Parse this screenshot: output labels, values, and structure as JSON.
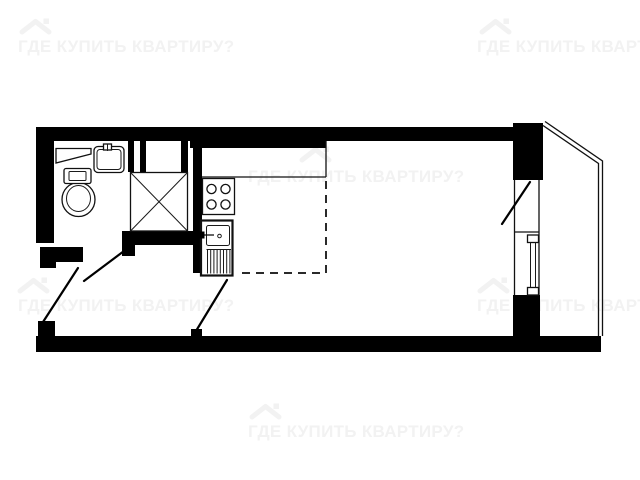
{
  "watermark": {
    "text": "ГДЕ КУПИТЬ КВАРТИРУ?",
    "color": "#f2f2f2",
    "icon": "house-roof-icon",
    "tile_count": 6
  },
  "plan": {
    "type": "studio-apartment-floor-plan",
    "background": "#ffffff",
    "wall_color": "#000000",
    "line_color": "#111111",
    "kitchen_zone_style": "dashed",
    "fixtures": [
      "toilet",
      "washbasin",
      "bathroom-shelf",
      "ventilation-shaft",
      "stove-4-burners",
      "kitchen-sink-with-drainboard",
      "kitchen-counter",
      "kitchen-zone-boundary",
      "entrance-door-swing",
      "bathroom-door-swing",
      "room-door-swing",
      "balcony-door-swing",
      "balcony-window",
      "balcony"
    ]
  }
}
